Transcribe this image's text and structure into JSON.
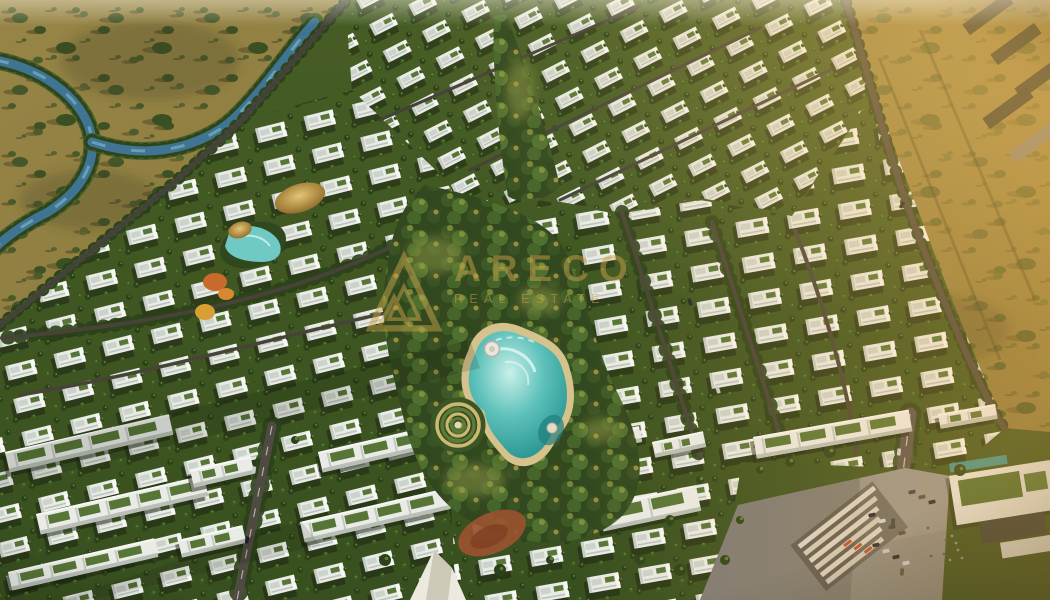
{
  "image": {
    "description": "Aerial 3D architectural render of a gated villa community masterplan with a central crystal lagoon park, palm-lined streets, rows of white villas and townhouses, an entrance plaza with parking, all surrounded by desert scrubland with a winding creek",
    "type": "architectural-aerial-render"
  },
  "watermark": {
    "logo_icon": "triangle-a-monogram-icon",
    "brand_text": "ARECO",
    "subtitle": "REAL ESTATE",
    "color": "#c8a24a"
  },
  "palette": {
    "desert": "#8f7f42",
    "desert_dark": "#6f6533",
    "desert_gold": "#b59a4e",
    "community_green": "#3d5222",
    "palm_green": "#2b411a",
    "palm_light": "#6c8b38",
    "villa_white": "#e9ebe7",
    "villa_shade": "#c6cdc5",
    "villa_lit": "#f6f7f3",
    "roof_gray": "#ccd3cb",
    "green_roof": "#567536",
    "road_dark": "#45423c",
    "road_wide": "#57524a",
    "lane_dash": "#cfc9ba",
    "lagoon_deep": "#2f9a96",
    "lagoon_light": "#c9f0e9",
    "foam_white": "#e7fbf6",
    "beach_sand": "#d6c28c",
    "river_blue": "#3f7592",
    "river_light": "#7fb3c8",
    "bank_green": "#4a5f2a",
    "thatch_gold": "#c9a24a",
    "plaza_gray": "#8b8a85",
    "plaza_shadow": "#6f6e69",
    "monument_cream": "#d8d3c8",
    "accent_orange": "#bc4a2c",
    "slide_orange": "#c96a2d",
    "playground_red": "#99522f",
    "shed_dark": "#383d31",
    "warm_light": "#ffb347"
  },
  "features": [
    "desert-terrain",
    "winding-creek",
    "villa-district-top",
    "villa-district-left",
    "villa-district-right",
    "central-park",
    "crystal-lagoon",
    "beach-edge",
    "circular-maze-garden",
    "lagoon-deck",
    "waterpark-pool",
    "thatched-roof-clubhouse",
    "water-slides",
    "townhouse-rows",
    "tree-lined-roads",
    "entrance-plaza",
    "entrance-monument",
    "parking-lot-cars",
    "green-roof-clubhouse",
    "playground-court",
    "event-tent",
    "industrial-sheds",
    "sunlight-glow",
    "brand-watermark"
  ]
}
